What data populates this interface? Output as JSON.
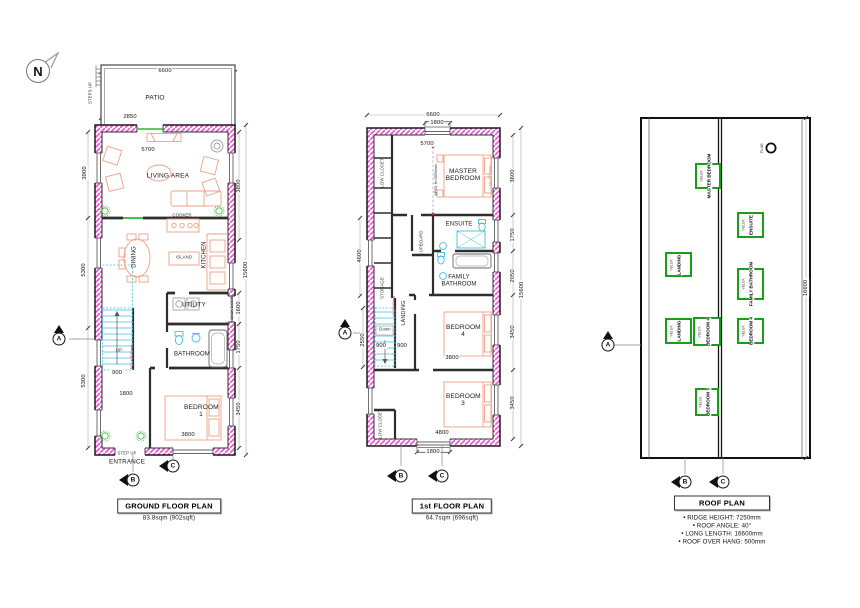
{
  "north": {
    "label": "N"
  },
  "ground": {
    "title": "GROUND FLOOR PLAN",
    "area": "83.8sqm (902sqft)",
    "rooms": {
      "patio": "PATIO",
      "living": "LIVING AREA",
      "dining": "DINING",
      "kitchen": "KITCHEN",
      "island": "ISLAND",
      "cooker": "COOKER",
      "utility": "UTILITY",
      "bathroom": "BATHROOM",
      "bedroom1": "BEDROOM 1"
    },
    "notes": {
      "steps_up": "STEPS UP",
      "up": "UP",
      "fcl": "FCL+2450mm",
      "back_door": "BACK DOOR",
      "step_up": "STEP UP",
      "entrance": "ENTRANCE"
    },
    "dims": {
      "top_width": "6600",
      "patio_width": "2850",
      "living_width": "5700",
      "living_depth": "3900",
      "mid_depth": "5300",
      "lower_depth": "5300",
      "right_upper": "3800",
      "total_depth": "15600",
      "utility_depth": "1600",
      "bath_depth": "1750",
      "bed_depth": "3450",
      "stair_width": "900",
      "hall_width": "1800",
      "bed_width": "3800"
    },
    "markers": {
      "a": "A",
      "b": "B",
      "c": "C"
    }
  },
  "first": {
    "title": "1st FLOOR PLAN",
    "area": "64.7sqm (696sqft)",
    "rooms": {
      "master": "MASTER BEDROOM",
      "ensuite": "ENSUITE",
      "family_bath": "FAMILY BATHROOM",
      "bedroom4": "BEDROOM 4",
      "bedroom3": "BEDROOM 3",
      "landing": "LANDING",
      "cupboard": "CUPBOARD",
      "storage": "STORAGE",
      "low_closet_top": "LOW CLOSET",
      "low_closet_bottom": "LOW CLOSET"
    },
    "notes": {
      "apex": "APEX H=3500mm",
      "h_right": "H=1200mm",
      "h_stairs": "H=2000mm",
      "down": "Down"
    },
    "dims": {
      "top_width": "6600",
      "top_opening": "1800",
      "inner_width": "5700",
      "left_upper": "4600",
      "left_stairs": "2550",
      "master_depth": "3600",
      "ensuite_depth": "1750",
      "bath_depth": "2050",
      "total_depth": "15600",
      "bed4_depth": "3450",
      "bed3_depth": "3450",
      "stair_a": "900",
      "stair_b": "900",
      "bed4_width": "3800",
      "bed3_width": "4800",
      "bottom_opening": "1800"
    },
    "markers": {
      "a": "A",
      "b": "B",
      "c": "C"
    }
  },
  "roof": {
    "title": "ROOF PLAN",
    "window_type": "VELUX",
    "flue": "FLUE",
    "windows": [
      {
        "label": "MASTER BEDROOM"
      },
      {
        "label": "ENSUITE"
      },
      {
        "label": "LANDING"
      },
      {
        "label": "FAMILY BATHROOM"
      },
      {
        "label": "LANDING"
      },
      {
        "label": "BEDROOM 4"
      },
      {
        "label": "BEDROOM 4"
      },
      {
        "label": "BEDROOM 3"
      }
    ],
    "dims": {
      "length": "16600"
    },
    "notes": [
      "• RIDGE HEIGHT: 7250mm",
      "• ROOF ANGLE: 40°",
      "• LONG LENGTH: 16600mm",
      "• ROOF OVER HANG: 500mm"
    ],
    "markers": {
      "a": "A",
      "b": "B",
      "c": "C"
    }
  }
}
